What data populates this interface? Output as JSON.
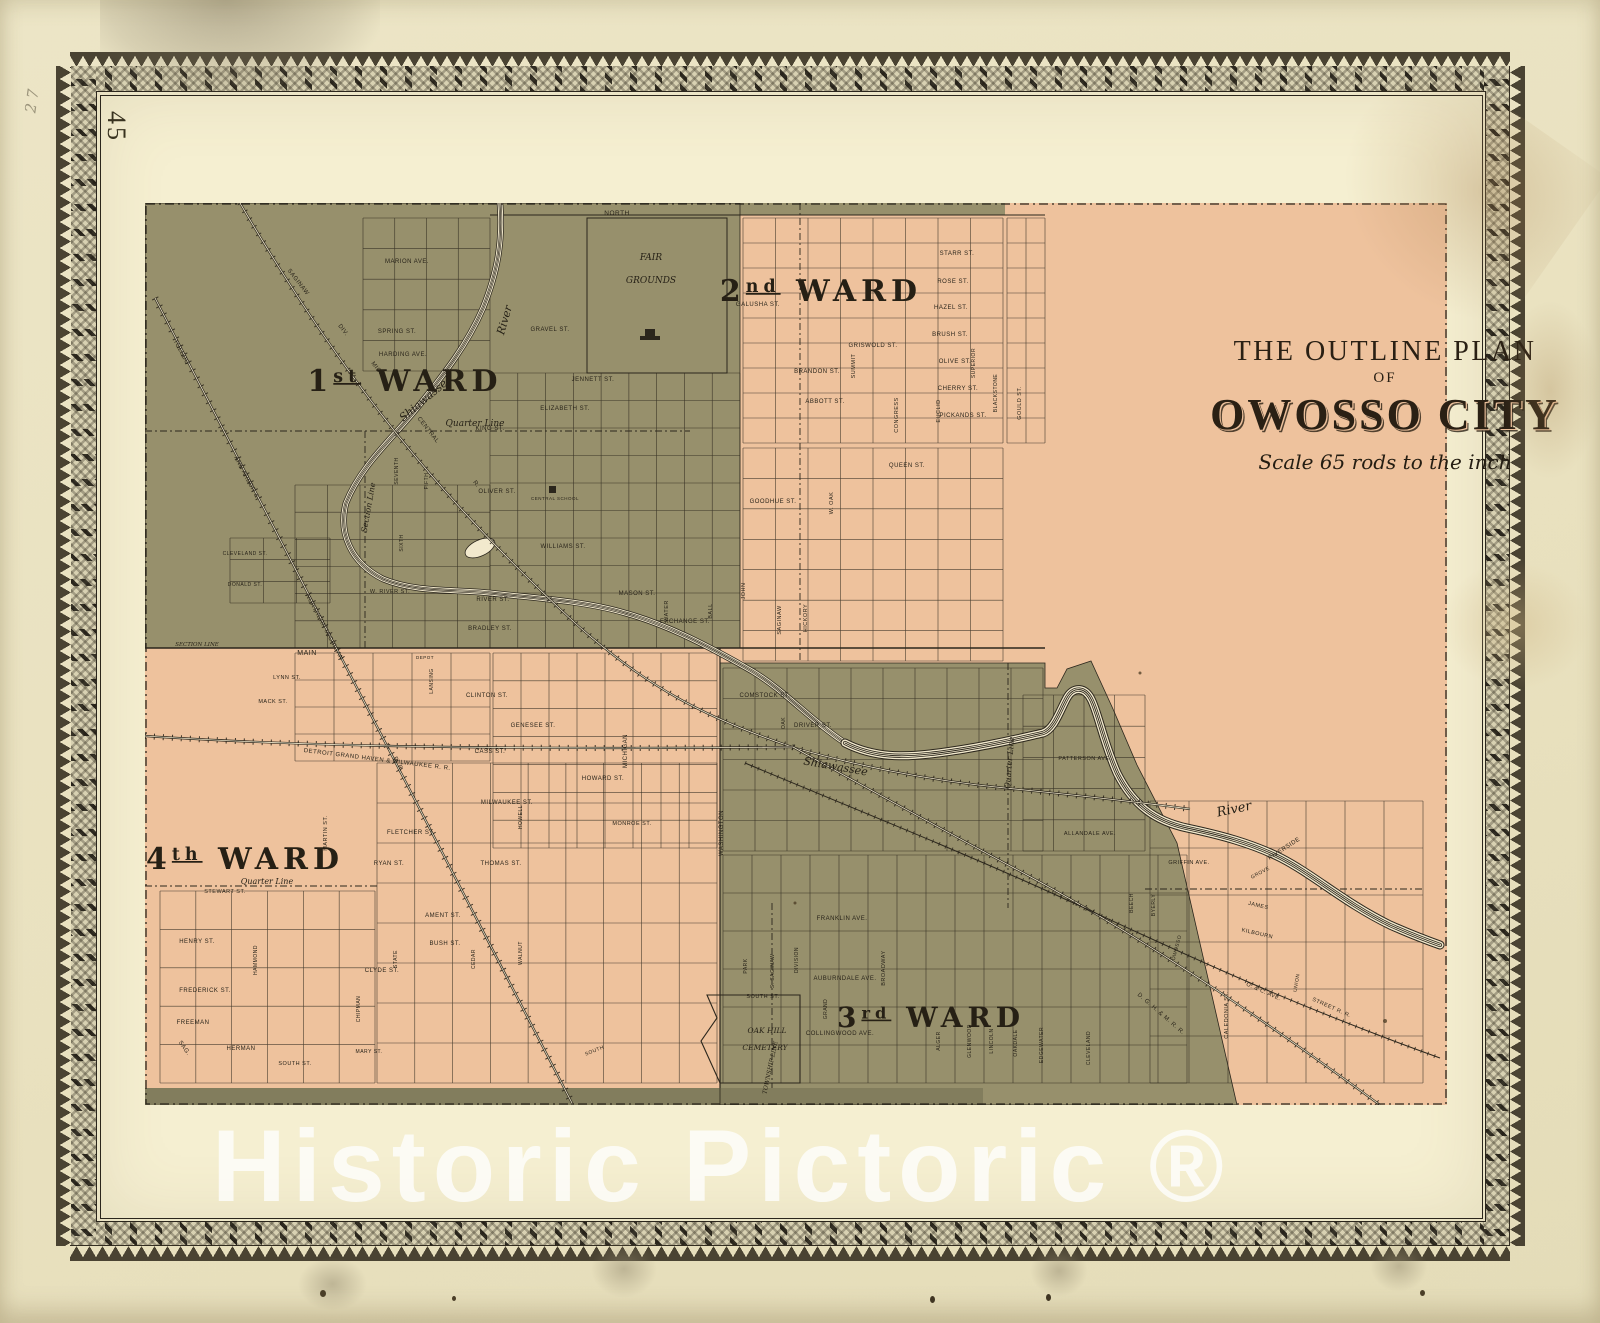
{
  "page": {
    "number": "45",
    "handwritten_note": "2 7",
    "watermark": "Historic Pictoric ®"
  },
  "title": {
    "line1": "THE OUTLINE PLAN",
    "line2": "OF",
    "line3": "OWOSSO CITY",
    "scale_note": "Scale  65  rods to the inch"
  },
  "colors": {
    "paper_outer": "#e9e2c2",
    "paper_inner": "#f5efd1",
    "ward_olive": "#97906c",
    "ward_olive_dark": "#827d5d",
    "ward_pink": "#eec29d",
    "ink": "#2b261c",
    "river_paper": "#f2e9cd",
    "watermark": "#ffffff"
  },
  "wards": [
    {
      "num": "1",
      "suffix": "st",
      "word": "WARD",
      "x": 260,
      "y": 188,
      "size": 30
    },
    {
      "num": "2",
      "suffix": "nd",
      "word": "WARD",
      "x": 676,
      "y": 98,
      "size": 30
    },
    {
      "num": "3",
      "suffix": "rd",
      "word": "WARD",
      "x": 786,
      "y": 824,
      "size": 28
    },
    {
      "num": "4",
      "suffix": "th",
      "word": "WARD",
      "x": 100,
      "y": 666,
      "size": 30
    }
  ],
  "map": {
    "labels": [
      {
        "t": "NORTH",
        "x": 472,
        "y": 12,
        "s": 6.5
      },
      {
        "t": "MARION AVE.",
        "x": 262,
        "y": 60
      },
      {
        "t": "SPRING ST.",
        "x": 252,
        "y": 130
      },
      {
        "t": "HARDING AVE.",
        "x": 258,
        "y": 153
      },
      {
        "t": "GRAVEL ST.",
        "x": 405,
        "y": 128
      },
      {
        "t": "JENNETT ST.",
        "x": 448,
        "y": 178
      },
      {
        "t": "ELIZABETH ST.",
        "x": 420,
        "y": 207
      },
      {
        "t": "KING ST.",
        "x": 345,
        "y": 227
      },
      {
        "t": "OLIVER ST.",
        "x": 352,
        "y": 290
      },
      {
        "t": "WILLIAMS ST.",
        "x": 418,
        "y": 345
      },
      {
        "t": "CENTRAL SCHOOL",
        "x": 410,
        "y": 297,
        "s": 4.5
      },
      {
        "t": "W. RIVER ST.",
        "x": 245,
        "y": 390,
        "s": 5.5
      },
      {
        "t": "RIVER ST.",
        "x": 348,
        "y": 398
      },
      {
        "t": "BRADLEY ST.",
        "x": 345,
        "y": 427
      },
      {
        "t": "MASON ST.",
        "x": 492,
        "y": 392
      },
      {
        "t": "EXCHANGE ST.",
        "x": 540,
        "y": 420
      },
      {
        "t": "WATER",
        "x": 523,
        "y": 408,
        "r": -90,
        "s": 5.5
      },
      {
        "t": "BALL",
        "x": 567,
        "y": 408,
        "r": -90,
        "s": 5.5
      },
      {
        "t": "JOHN",
        "x": 600,
        "y": 388,
        "r": -90,
        "s": 5.5
      },
      {
        "t": "MAIN",
        "x": 162,
        "y": 452,
        "s": 7
      },
      {
        "t": "SECTION LINE",
        "x": 52,
        "y": 443,
        "s": 5.5,
        "i": 1
      },
      {
        "t": "Quarter Line",
        "x": 330,
        "y": 223,
        "i": 1,
        "s": 9
      },
      {
        "t": "Section Line",
        "x": 226,
        "y": 305,
        "r": -80,
        "i": 1,
        "s": 8
      },
      {
        "t": "Shiawassee",
        "x": 283,
        "y": 198,
        "r": -40,
        "i": 1,
        "s": 11
      },
      {
        "t": "River",
        "x": 363,
        "y": 118,
        "r": -74,
        "i": 1,
        "s": 11
      },
      {
        "t": "FAIR",
        "x": 506,
        "y": 57,
        "i": 1,
        "s": 9
      },
      {
        "t": "GROUNDS",
        "x": 506,
        "y": 80,
        "i": 1,
        "s": 9
      },
      {
        "t": "TOLEDO",
        "x": 35,
        "y": 150,
        "r": 62,
        "s": 6
      },
      {
        "t": "ANN ARBOR &",
        "x": 100,
        "y": 275,
        "r": 62,
        "s": 6
      },
      {
        "t": "NORTHERN MICHIGAN",
        "x": 178,
        "y": 425,
        "r": 62,
        "s": 6
      },
      {
        "t": "R. R.",
        "x": 252,
        "y": 562,
        "r": 62,
        "s": 6
      },
      {
        "t": "SAGINAW",
        "x": 152,
        "y": 80,
        "r": 52,
        "s": 6
      },
      {
        "t": "DIV.",
        "x": 197,
        "y": 128,
        "r": 52,
        "s": 6
      },
      {
        "t": "MICH.",
        "x": 232,
        "y": 168,
        "r": 52,
        "s": 6
      },
      {
        "t": "CENTRAL",
        "x": 282,
        "y": 228,
        "r": 52,
        "s": 6
      },
      {
        "t": "R.",
        "x": 330,
        "y": 282,
        "r": 52,
        "s": 6
      },
      {
        "t": "SEVENTH",
        "x": 253,
        "y": 268,
        "r": -90,
        "s": 5
      },
      {
        "t": "FIFTH",
        "x": 283,
        "y": 278,
        "r": -90,
        "s": 5
      },
      {
        "t": "SIXTH",
        "x": 258,
        "y": 340,
        "r": -90,
        "s": 5
      },
      {
        "t": "CLEVELAND ST.",
        "x": 100,
        "y": 352,
        "s": 5
      },
      {
        "t": "DONALD ST.",
        "x": 100,
        "y": 383,
        "s": 5
      },
      {
        "t": "DEPOT",
        "x": 280,
        "y": 456,
        "s": 4.5
      },
      {
        "t": "GALUSHA ST.",
        "x": 613,
        "y": 103
      },
      {
        "t": "BRANDON ST.",
        "x": 672,
        "y": 170
      },
      {
        "t": "GRISWOLD ST.",
        "x": 728,
        "y": 144
      },
      {
        "t": "ABBOTT ST.",
        "x": 680,
        "y": 200
      },
      {
        "t": "SUMMIT",
        "x": 710,
        "y": 163,
        "r": -90,
        "s": 5.5
      },
      {
        "t": "CONGRESS",
        "x": 753,
        "y": 212,
        "r": -90,
        "s": 5.5
      },
      {
        "t": "EUCLID",
        "x": 795,
        "y": 208,
        "r": -90,
        "s": 5.5
      },
      {
        "t": "STARR ST.",
        "x": 812,
        "y": 52
      },
      {
        "t": "ROSE ST.",
        "x": 808,
        "y": 80
      },
      {
        "t": "HAZEL ST.",
        "x": 806,
        "y": 106
      },
      {
        "t": "BRUSH ST.",
        "x": 805,
        "y": 133
      },
      {
        "t": "OLIVE ST.",
        "x": 810,
        "y": 160
      },
      {
        "t": "CHERRY ST.",
        "x": 813,
        "y": 187
      },
      {
        "t": "PICKANDS ST.",
        "x": 818,
        "y": 214
      },
      {
        "t": "SUPERIOR",
        "x": 830,
        "y": 160,
        "r": -90,
        "s": 5
      },
      {
        "t": "BLACKSTONE",
        "x": 852,
        "y": 190,
        "r": -90,
        "s": 5
      },
      {
        "t": "GOULD ST.",
        "x": 876,
        "y": 200,
        "r": -90,
        "s": 5.5
      },
      {
        "t": "GOODHUE ST.",
        "x": 628,
        "y": 300
      },
      {
        "t": "QUEEN ST.",
        "x": 762,
        "y": 264
      },
      {
        "t": "W. OAK",
        "x": 688,
        "y": 300,
        "r": -90,
        "s": 5.5
      },
      {
        "t": "HICKORY",
        "x": 662,
        "y": 415,
        "r": -90,
        "s": 5.5
      },
      {
        "t": "SAGINAW",
        "x": 636,
        "y": 417,
        "r": -90,
        "s": 5.5
      },
      {
        "t": "CLINTON ST.",
        "x": 342,
        "y": 494
      },
      {
        "t": "GENESEE ST.",
        "x": 388,
        "y": 524
      },
      {
        "t": "CASS ST.",
        "x": 345,
        "y": 550
      },
      {
        "t": "MICHIGAN",
        "x": 482,
        "y": 548,
        "r": -90,
        "s": 6
      },
      {
        "t": "HOWARD ST.",
        "x": 458,
        "y": 577
      },
      {
        "t": "MILWAUKEE ST.",
        "x": 362,
        "y": 601
      },
      {
        "t": "MONROE ST.",
        "x": 487,
        "y": 622,
        "s": 5.5
      },
      {
        "t": "LANSING",
        "x": 288,
        "y": 478,
        "r": -90,
        "s": 5
      },
      {
        "t": "MACK ST.",
        "x": 128,
        "y": 500,
        "s": 5.5
      },
      {
        "t": "LYNN ST.",
        "x": 142,
        "y": 476,
        "s": 5.5
      },
      {
        "t": "COMSTOCK ST.",
        "x": 620,
        "y": 494
      },
      {
        "t": "DRIVER ST.",
        "x": 668,
        "y": 524
      },
      {
        "t": "OAK",
        "x": 640,
        "y": 520,
        "r": -90,
        "s": 5
      },
      {
        "t": "Shiawassee",
        "x": 690,
        "y": 567,
        "r": 10,
        "i": 1,
        "s": 11
      },
      {
        "t": "FRANKLIN AVE.",
        "x": 697,
        "y": 717
      },
      {
        "t": "AUBURNDALE AVE.",
        "x": 700,
        "y": 777
      },
      {
        "t": "COLLINGWOOD AVE.",
        "x": 695,
        "y": 832
      },
      {
        "t": "BROADWAY",
        "x": 740,
        "y": 765,
        "r": -90,
        "s": 5.5
      },
      {
        "t": "GRAND",
        "x": 682,
        "y": 806,
        "r": -90,
        "s": 5
      },
      {
        "t": "WASHINGTON",
        "x": 578,
        "y": 630,
        "r": -90,
        "s": 6
      },
      {
        "t": "DIVISION",
        "x": 653,
        "y": 757,
        "r": -90,
        "s": 5
      },
      {
        "t": "PARK",
        "x": 602,
        "y": 763,
        "r": -90,
        "s": 5
      },
      {
        "t": "S. SAGINAW",
        "x": 629,
        "y": 768,
        "r": -90,
        "s": 5
      },
      {
        "t": "SOUTH ST.",
        "x": 618,
        "y": 795,
        "s": 5.5
      },
      {
        "t": "SOUTH",
        "x": 450,
        "y": 849,
        "r": -22,
        "s": 5
      },
      {
        "t": "TOWNSHIP LINE",
        "x": 627,
        "y": 865,
        "r": -78,
        "i": 1,
        "s": 6
      },
      {
        "t": "OAK HILL",
        "x": 622,
        "y": 830,
        "i": 1,
        "s": 7.5
      },
      {
        "t": "CEMETERY",
        "x": 620,
        "y": 847,
        "i": 1,
        "s": 7.5
      },
      {
        "t": "ALGER",
        "x": 795,
        "y": 838,
        "r": -90,
        "s": 5
      },
      {
        "t": "GLENWOOD",
        "x": 826,
        "y": 838,
        "r": -90,
        "s": 5
      },
      {
        "t": "LINCOLN",
        "x": 848,
        "y": 838,
        "r": -90,
        "s": 5
      },
      {
        "t": "OAKDALE",
        "x": 872,
        "y": 840,
        "r": -90,
        "s": 5
      },
      {
        "t": "EDGEWATER",
        "x": 898,
        "y": 842,
        "r": -90,
        "s": 5
      },
      {
        "t": "CLEVELAND",
        "x": 945,
        "y": 845,
        "r": -90,
        "s": 5
      },
      {
        "t": "PATTERSON AVE.",
        "x": 940,
        "y": 557,
        "s": 5.5
      },
      {
        "t": "ALLANDALE AVE.",
        "x": 945,
        "y": 632,
        "s": 5.5
      },
      {
        "t": "Quarter Line",
        "x": 867,
        "y": 560,
        "r": -85,
        "i": 1,
        "s": 8
      },
      {
        "t": "River",
        "x": 1090,
        "y": 610,
        "r": -12,
        "i": 1,
        "s": 13
      },
      {
        "t": "RIVERSIDE",
        "x": 1140,
        "y": 647,
        "r": -33,
        "s": 6
      },
      {
        "t": "GRIFFIN AVE.",
        "x": 1044,
        "y": 661,
        "s": 5.5
      },
      {
        "t": "GROVE",
        "x": 1116,
        "y": 671,
        "r": -28,
        "s": 5
      },
      {
        "t": "JAMES",
        "x": 1113,
        "y": 704,
        "r": 13,
        "s": 5.5
      },
      {
        "t": "KILBOURN",
        "x": 1112,
        "y": 732,
        "r": 13,
        "s": 5.5
      },
      {
        "t": "CALEDONIA ST.",
        "x": 1083,
        "y": 812,
        "r": -90,
        "s": 5.5
      },
      {
        "t": "UNION",
        "x": 1153,
        "y": 780,
        "r": -80,
        "s": 5
      },
      {
        "t": "O. & C. AVE.",
        "x": 1118,
        "y": 790,
        "r": 24,
        "s": 5.5
      },
      {
        "t": "STREET R. R.",
        "x": 1186,
        "y": 806,
        "r": 24,
        "s": 5.5
      },
      {
        "t": "D. G. H. & M. R. R.",
        "x": 1015,
        "y": 812,
        "r": 41,
        "s": 6
      },
      {
        "t": "BEECH",
        "x": 988,
        "y": 700,
        "r": -90,
        "s": 5
      },
      {
        "t": "BYERLY",
        "x": 1010,
        "y": 702,
        "r": -90,
        "s": 5
      },
      {
        "t": "OWOSSO",
        "x": 1033,
        "y": 745,
        "r": -75,
        "s": 5
      },
      {
        "t": "Quarter Line",
        "x": 122,
        "y": 681,
        "i": 1,
        "s": 8
      },
      {
        "t": "STEWART ST.",
        "x": 80,
        "y": 690,
        "s": 5.5
      },
      {
        "t": "HENRY ST.",
        "x": 52,
        "y": 740
      },
      {
        "t": "FREDERICK ST.",
        "x": 60,
        "y": 789
      },
      {
        "t": "FREEMAN",
        "x": 48,
        "y": 821
      },
      {
        "t": "HERMAN",
        "x": 96,
        "y": 847
      },
      {
        "t": "SOUTH ST.",
        "x": 150,
        "y": 862,
        "s": 5.5
      },
      {
        "t": "MARY ST.",
        "x": 224,
        "y": 850,
        "s": 5
      },
      {
        "t": "CLYDE ST.",
        "x": 237,
        "y": 769
      },
      {
        "t": "AMENT ST.",
        "x": 298,
        "y": 714
      },
      {
        "t": "BUSH ST.",
        "x": 300,
        "y": 742
      },
      {
        "t": "RYAN ST.",
        "x": 244,
        "y": 662
      },
      {
        "t": "THOMAS ST.",
        "x": 356,
        "y": 662
      },
      {
        "t": "FLETCHER ST.",
        "x": 266,
        "y": 631
      },
      {
        "t": "STATE",
        "x": 252,
        "y": 756,
        "r": -90,
        "s": 5
      },
      {
        "t": "CEDAR",
        "x": 330,
        "y": 756,
        "r": -90,
        "s": 5
      },
      {
        "t": "WALNUT",
        "x": 377,
        "y": 750,
        "r": -90,
        "s": 5
      },
      {
        "t": "HOWELL",
        "x": 377,
        "y": 614,
        "r": -90,
        "s": 5
      },
      {
        "t": "HAMMOND",
        "x": 112,
        "y": 757,
        "r": -90,
        "s": 5
      },
      {
        "t": "MARTIN ST.",
        "x": 182,
        "y": 630,
        "r": -90,
        "s": 5.5
      },
      {
        "t": "CHIPMAN",
        "x": 215,
        "y": 806,
        "r": -90,
        "s": 5
      },
      {
        "t": "DETROIT GRAND HAVEN & MILWAUKEE R. R.",
        "x": 232,
        "y": 558,
        "r": 7,
        "s": 6
      },
      {
        "t": "SAG.",
        "x": 38,
        "y": 846,
        "r": 55,
        "s": 6
      }
    ]
  }
}
